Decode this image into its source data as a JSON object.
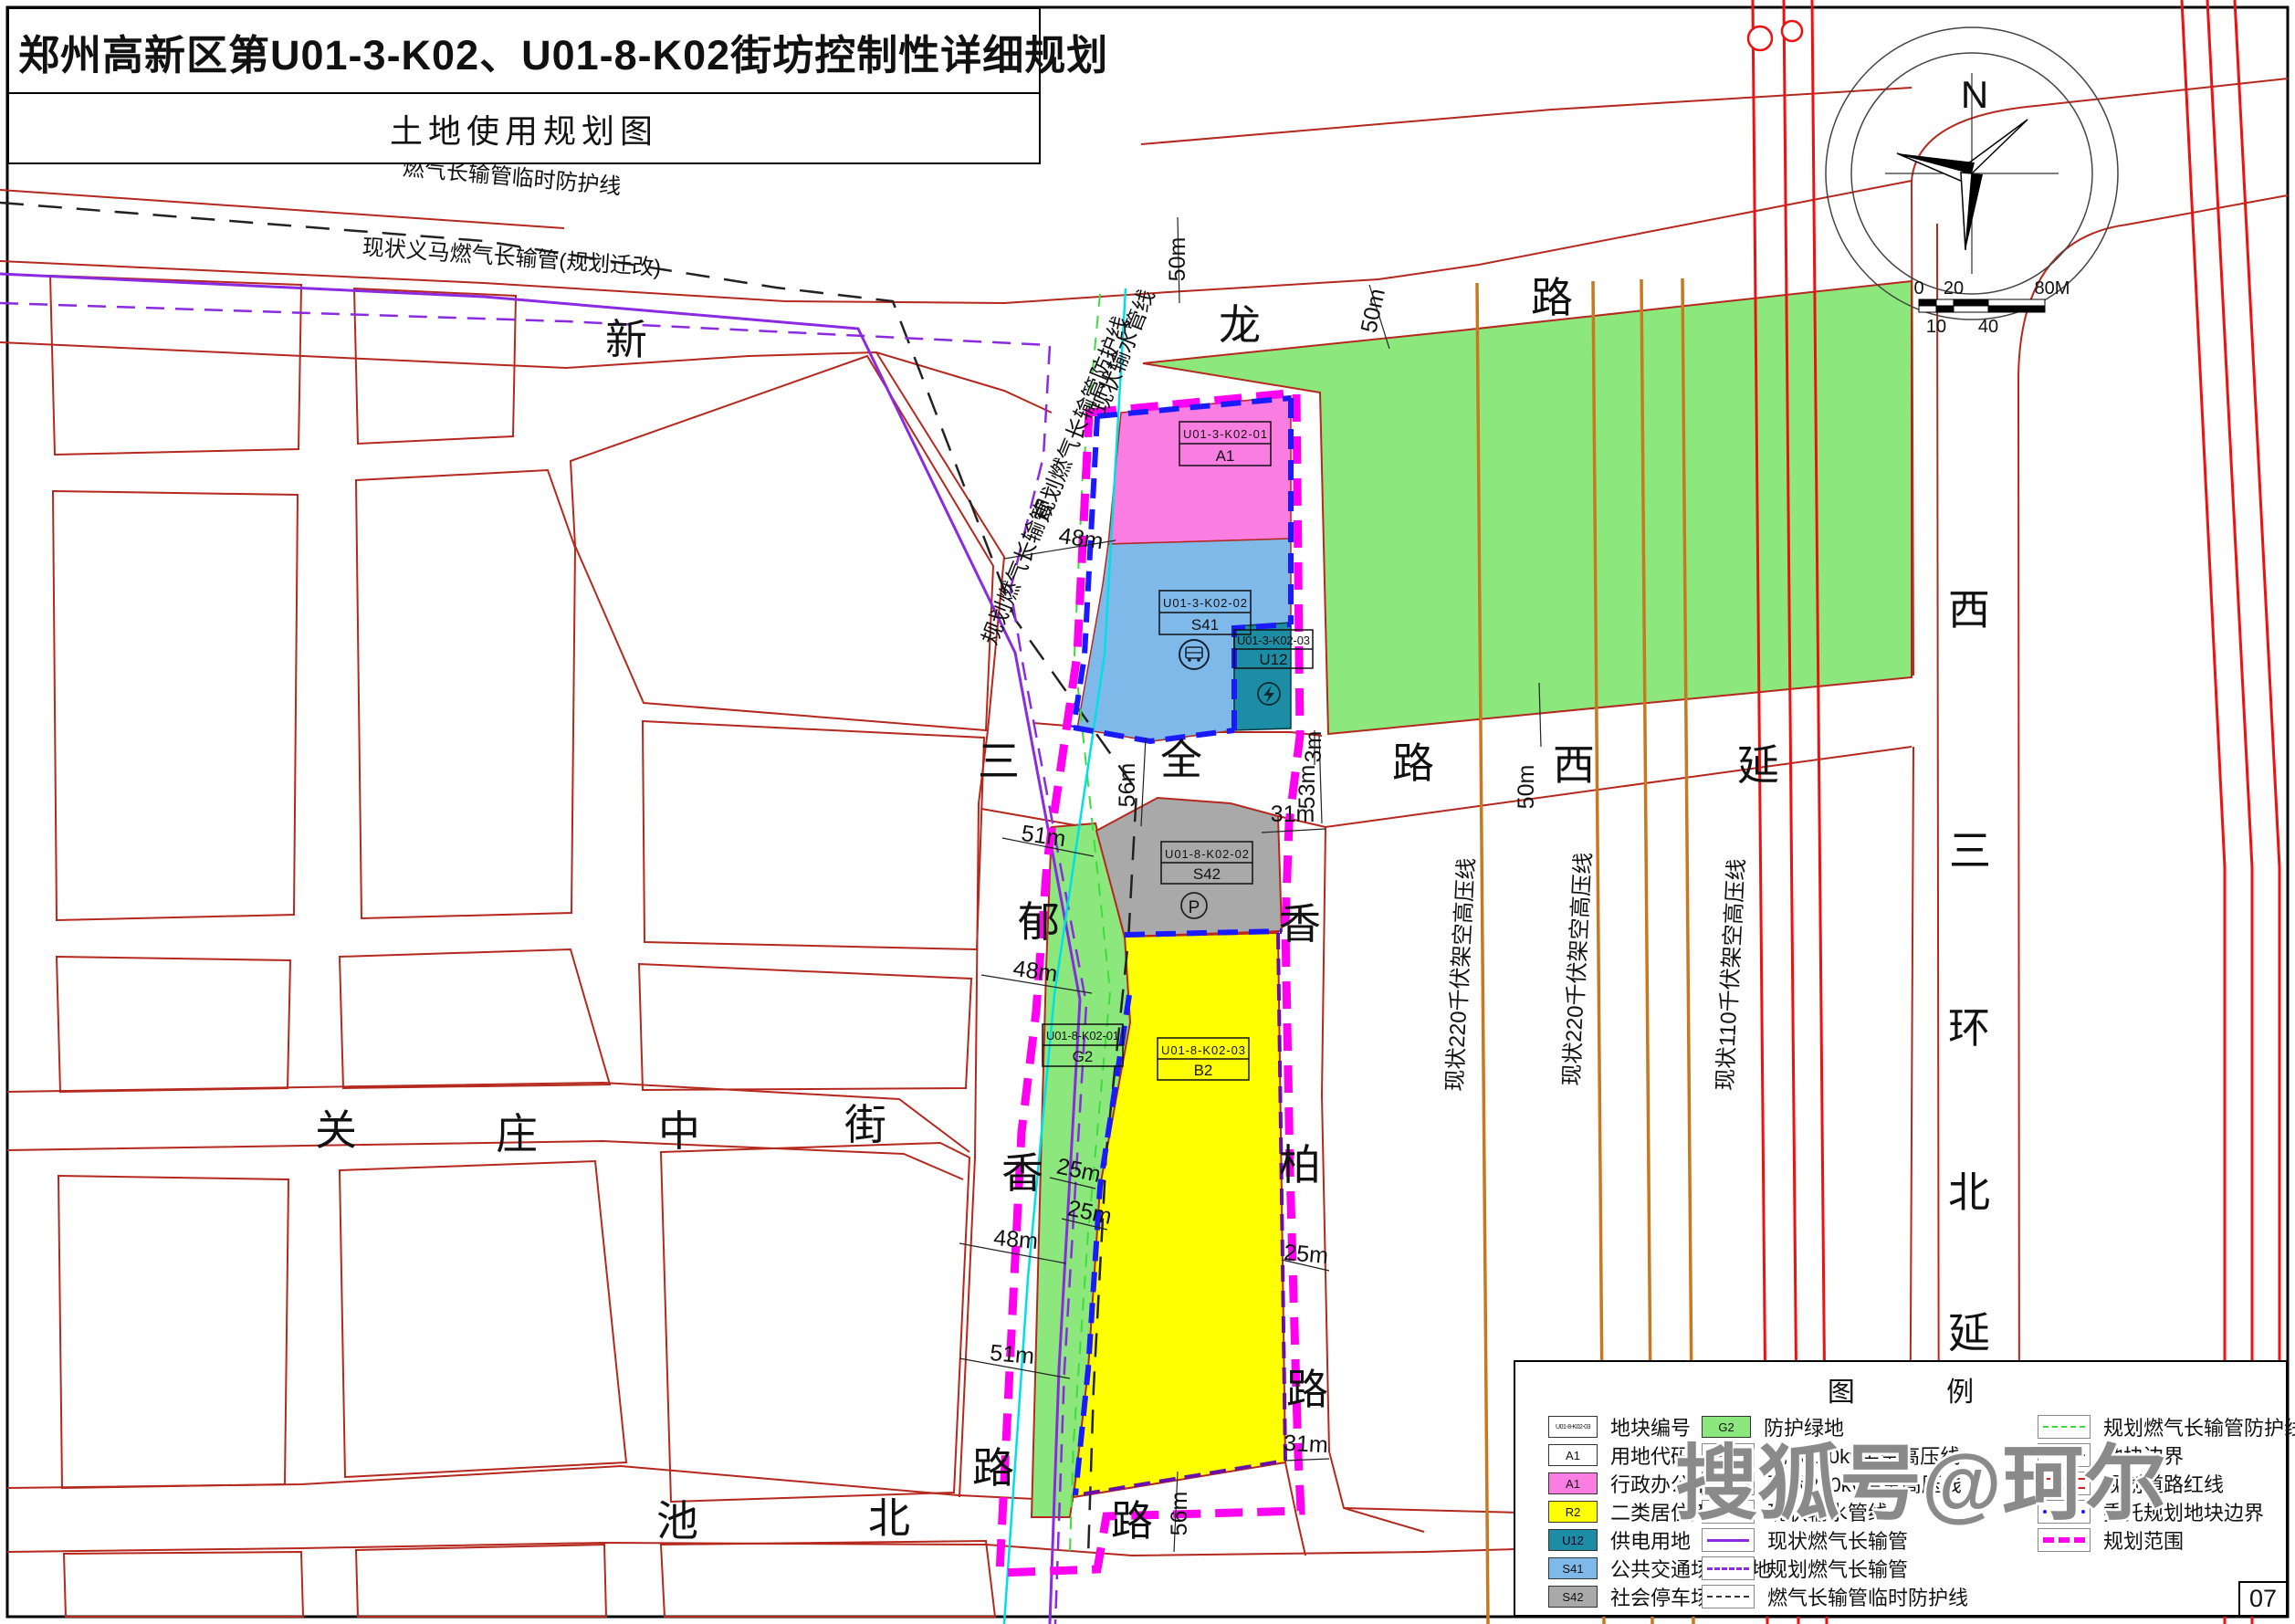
{
  "title": {
    "main": "郑州高新区第U01-3-K02、U01-8-K02街坊控制性详细规划",
    "sub": "土地使用规划图"
  },
  "page_number": "07",
  "watermark": "搜狐号@珂尔",
  "compass": {
    "north": "N",
    "scale_top": [
      "0",
      "20",
      "80M"
    ],
    "scale_bottom": [
      "10",
      "40"
    ]
  },
  "icons": {
    "parking": "P"
  },
  "roads": {
    "xinlong": [
      "新",
      "龙",
      "路"
    ],
    "sanquan_xiyan": [
      "三",
      "全",
      "路",
      "西",
      "延"
    ],
    "yuxiang": [
      "郁",
      "香",
      "路"
    ],
    "xiangbai": [
      "香",
      "柏",
      "路"
    ],
    "xisanhuan_beiyan": [
      "西",
      "三",
      "环",
      "北",
      "延"
    ],
    "guanzhuang": [
      "关",
      "庄",
      "中",
      "街"
    ],
    "chibei": [
      "池",
      "北",
      "路"
    ]
  },
  "blocks": [
    {
      "code": "U01-3-K02-01",
      "use": "A1"
    },
    {
      "code": "U01-3-K02-02",
      "use": "S41"
    },
    {
      "code": "U01-3-K02-03",
      "use": "U12"
    },
    {
      "code": "U01-8-K02-01",
      "use": "G2"
    },
    {
      "code": "U01-8-K02-02",
      "use": "S42"
    },
    {
      "code": "U01-8-K02-03",
      "use": "B2"
    }
  ],
  "pipelines": {
    "temp_protect": "燃气长输管临时防护线",
    "existing_yima": "现状义马燃气长输管(规划迁改)",
    "planned_gas": "规划燃气长输管",
    "planned_gas_protect": "规划燃气长输管防护线",
    "existing_water": "现状输水管线",
    "hv220": "现状220千伏架空高压线",
    "hv110": "现状110千伏架空高压线"
  },
  "dims": [
    "50m",
    "50m",
    "48m",
    "3m",
    "56m",
    "53m",
    "50m",
    "31m",
    "51m",
    "48m",
    "25m",
    "25m",
    "48m",
    "25m",
    "51m",
    "31m",
    "56m"
  ],
  "legend": {
    "title": "图 例",
    "col1": [
      {
        "swatch": "code-box",
        "swatch_text": "U01-8-K02-03",
        "label": "地块编号"
      },
      {
        "swatch": "white-box",
        "swatch_text": "A1",
        "label": "用地代码"
      },
      {
        "swatch": "pink",
        "swatch_text": "A1",
        "label": "行政办公用地"
      },
      {
        "swatch": "yellow",
        "swatch_text": "R2",
        "label": "二类居住用地"
      },
      {
        "swatch": "teal",
        "swatch_text": "U12",
        "label": "供电用地"
      },
      {
        "swatch": "lightblue",
        "swatch_text": "S41",
        "label": "公共交通场站用地"
      },
      {
        "swatch": "gray",
        "swatch_text": "S42",
        "label": "社会停车场用地"
      }
    ],
    "col2": [
      {
        "swatch": "green",
        "swatch_text": "G2",
        "label": "防护绿地"
      },
      {
        "line": "red-solid",
        "label": "现状110kv架空高压线"
      },
      {
        "line": "orange-solid",
        "label": "现状220kv架空高压线"
      },
      {
        "line": "cyan-solid",
        "label": "现状输水管线"
      },
      {
        "line": "purple-solid",
        "label": "现状燃气长输管"
      },
      {
        "line": "purple-dashed",
        "label": "规划燃气长输管"
      },
      {
        "line": "black-dashed",
        "label": "燃气长输管临时防护线"
      }
    ],
    "col3": [
      {
        "line": "green-dashed",
        "label": "规划燃气长输管防护线"
      },
      {
        "line": "black-solid",
        "label": "地块边界"
      },
      {
        "line": "red-double",
        "label": "规划道路红线"
      },
      {
        "line": "blue-dotted",
        "label": "委托规划地块边界"
      },
      {
        "line": "magenta-dashed",
        "label": "规划范围"
      }
    ]
  },
  "colors": {
    "admin_office": "#fa7de2",
    "residential": "#ffff00",
    "power_supply": "#1d8da6",
    "transit_station": "#7fb9ea",
    "parking": "#a9a9a9",
    "green_space": "#8ce87c",
    "planning_scope": "#ff00f0",
    "entrusted_boundary": "#1a1aff",
    "road_redline": "#b5281e",
    "hv110": "#ee1111",
    "hv220": "#c87820",
    "water": "#00dfe8",
    "gas": "#8a2be2"
  }
}
